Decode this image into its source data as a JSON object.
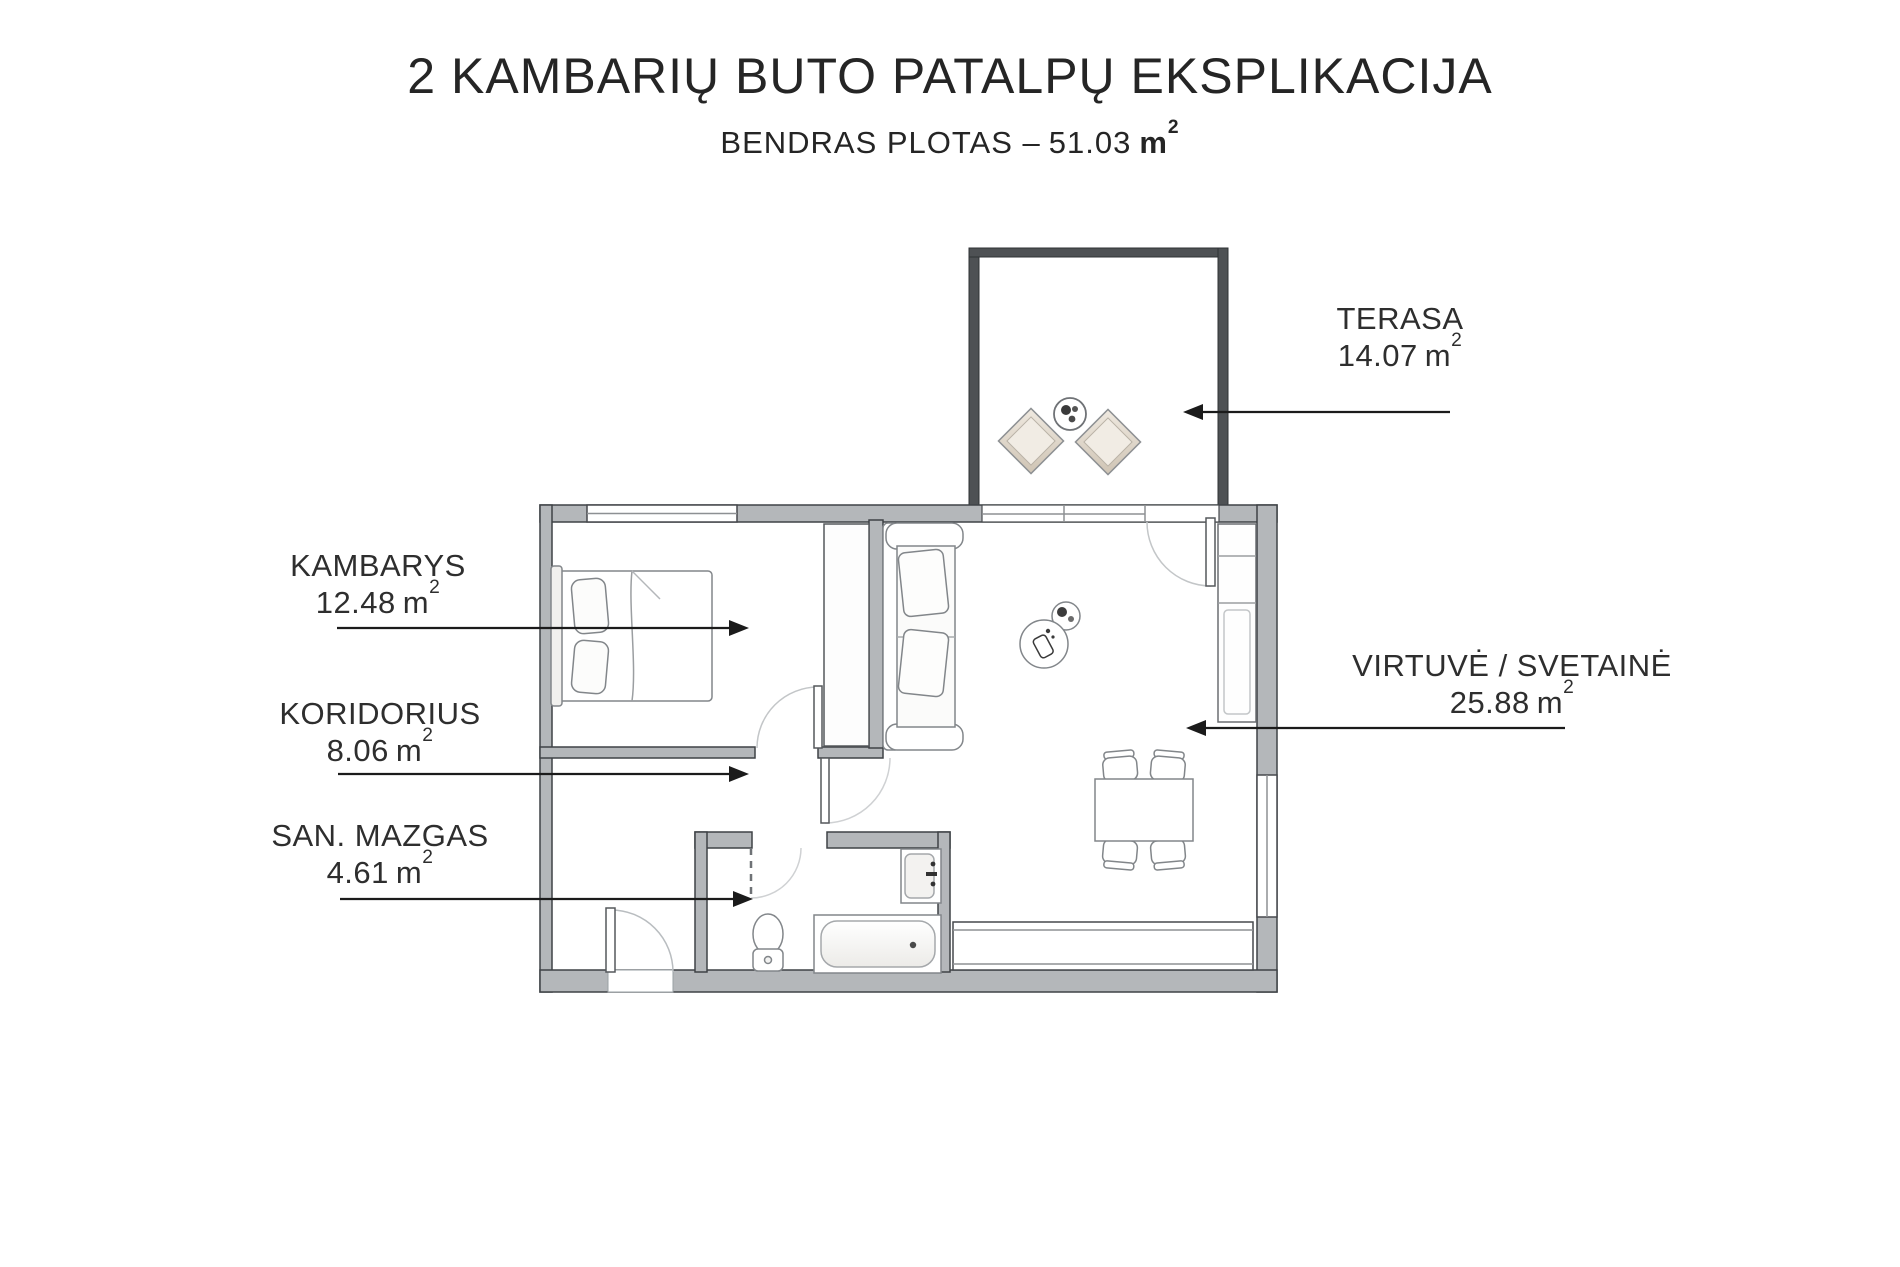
{
  "header": {
    "title": "2 KAMBARIŲ BUTO PATALPŲ EKSPLIKACIJA",
    "subtitle_label": "BENDRAS PLOTAS –",
    "total_area": "51.03"
  },
  "unit": {
    "base": "m",
    "sup": "2"
  },
  "rooms": [
    {
      "key": "terasa",
      "name": "TERASA",
      "area": "14.07"
    },
    {
      "key": "kambarys",
      "name": "KAMBARYS",
      "area": "12.48"
    },
    {
      "key": "koridorius",
      "name": "KORIDORIUS",
      "area": "8.06"
    },
    {
      "key": "san-mazgas",
      "name": "SAN. MAZGAS",
      "area": "4.61"
    },
    {
      "key": "virtuve",
      "name": "VIRTUVĖ / SVETAINĖ",
      "area": "25.88"
    }
  ],
  "colors": {
    "background": "#ffffff",
    "text": "#2b2b2b",
    "apartment_wall_fill": "#b4b7ba",
    "apartment_wall_outline": "#3f4246",
    "terrace_wall": "#4e5154",
    "arrow": "#1b1b1b",
    "furniture_outline": "#82868a",
    "cushion_fill": "#ddd4c7"
  }
}
